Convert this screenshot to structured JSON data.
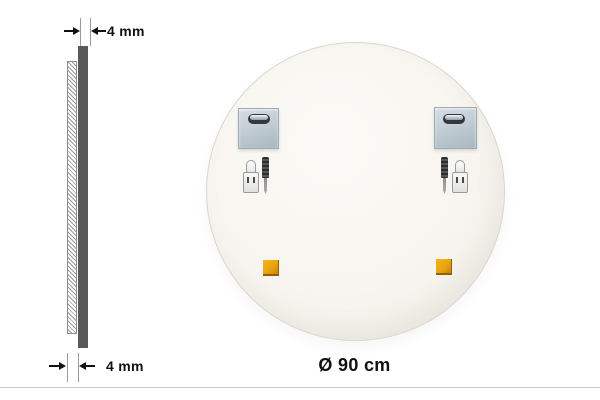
{
  "side_view": {
    "top_dimension_label": "4 mm",
    "bottom_dimension_label": "4 mm"
  },
  "back_view": {
    "diameter_label": "Ø 90 cm"
  },
  "icons": {
    "mounting_plate": "metal-plate-with-keyhole-slot",
    "wall_plug": "white-wall-plug",
    "screw": "black-screw",
    "adhesive_pad": "orange-square-pad"
  },
  "colors": {
    "panel_dark": "#58595b",
    "hatch_line": "#9a9a9a",
    "mirror_back_fill": "#f8f5f0",
    "plate_metal": "#c2cdd5",
    "pad_orange": "#e8a411",
    "divider": "#c7c7c7",
    "text": "#111111"
  }
}
